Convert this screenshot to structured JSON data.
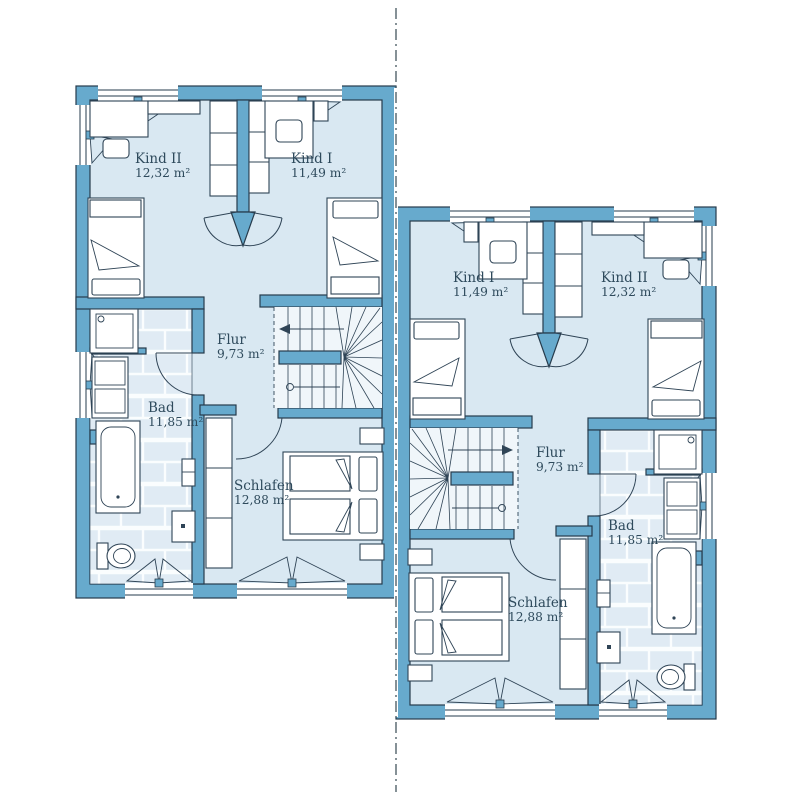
{
  "title": "Duplex upper floor plan",
  "colors": {
    "wall": "#67aacd",
    "room_fill": "#d9e8f2",
    "tile_fill": "#e0ebf4",
    "outline": "#263b4c",
    "text": "#2e4a5c"
  },
  "divider": {
    "style": "dash-dot-mirror-axis"
  },
  "units": [
    {
      "name": "unit-left",
      "rooms": [
        {
          "key": "kind2",
          "name": "Kind II",
          "area": "12,32 m²"
        },
        {
          "key": "kind1",
          "name": "Kind I",
          "area": "11,49 m²"
        },
        {
          "key": "flur",
          "name": "Flur",
          "area": "9,73 m²"
        },
        {
          "key": "bad",
          "name": "Bad",
          "area": "11,85 m²"
        },
        {
          "key": "schlafen",
          "name": "Schlafen",
          "area": "12,88 m²"
        }
      ]
    },
    {
      "name": "unit-right",
      "rooms": [
        {
          "key": "kind1",
          "name": "Kind I",
          "area": "11,49 m²"
        },
        {
          "key": "kind2",
          "name": "Kind II",
          "area": "12,32 m²"
        },
        {
          "key": "flur",
          "name": "Flur",
          "area": "9,73 m²"
        },
        {
          "key": "bad",
          "name": "Bad",
          "area": "11,85 m²"
        },
        {
          "key": "schlafen",
          "name": "Schlafen",
          "area": "12,88 m²"
        }
      ]
    }
  ]
}
